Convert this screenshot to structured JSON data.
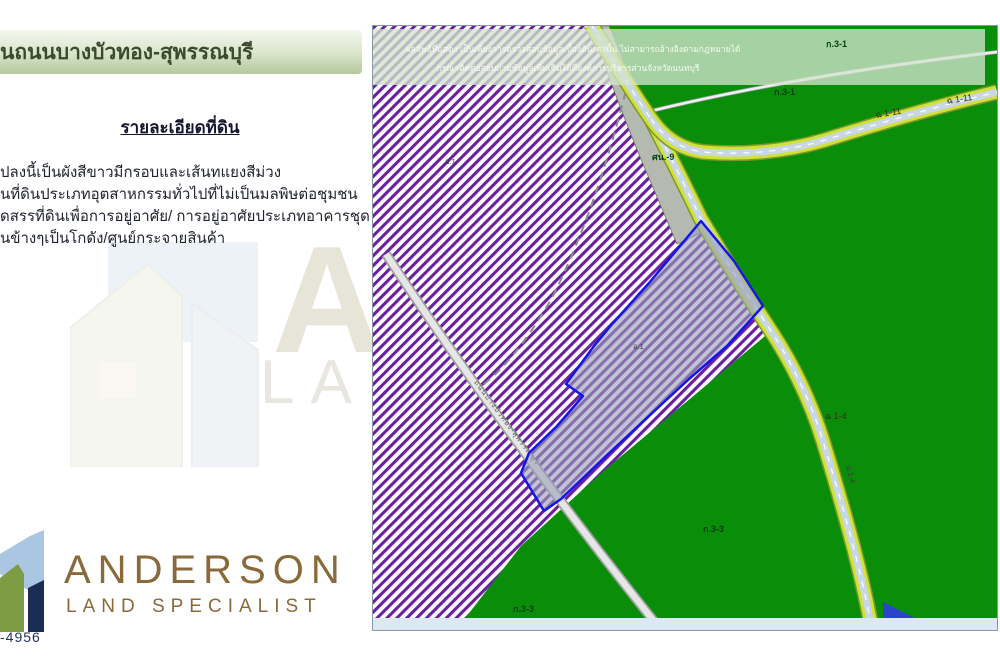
{
  "page": {
    "width": 1000,
    "height": 656
  },
  "left_panel": {
    "title": "นถนนบางบัวทอง-สุพรรณบุรี",
    "heading": "รายละเอียดที่ดิน",
    "details": [
      "ปลงนี้เป็นผังสีขาวมีกรอบและเส้นทแยงสีม่วง",
      "นที่ดินประเภทอุตสาหกรรมทั่วไปที่ไม่เป็นมลพิษต่อชุมชน",
      "ดสรรที่ดินเพื่อการอยู่อาศัย/ การอยู่อาศัยประเภทอาคารชุด",
      "นข้างๆเป็นโกดัง/ศูนย์กระจายสินค้า"
    ],
    "watermark": {
      "letter": "A",
      "word": "LAN"
    },
    "logo": {
      "name": "ANDERSON",
      "tagline": "LAND SPECIALIST"
    },
    "phone_fragment": "-4956"
  },
  "map": {
    "disclaimer": {
      "line1": "ผลลัพธ์ที่แสดง เป็นเพียงการตรวจสอบข้อมูลเบื้องต้นเท่านั้น ไม่สามารถอ้างอิงตามกฎหมายได้",
      "line2": "กรุณาติดต่อสอบถามข้อมูลเพิ่มเติมได้ที่องค์การบริหารส่วนจังหวัดนนทบุรี"
    },
    "zone_labels": {
      "k31_a": "ก.3-1",
      "k31_b": "ก.3-1",
      "sn9": "ศน.-9",
      "o1_a": "อ.1",
      "o1_b": "อ.1",
      "k33_a": "ก.3-3",
      "k33_b": "ก.3-3"
    },
    "road_labels": {
      "ch111_a": "ฉ 1-11",
      "ch111_b": "ฉ 1-11",
      "ch14": "ฉ 1-4",
      "ch14_v": "ฉ 1-4"
    },
    "road_name": "ถนนบางบัวทอง-สุพรรณบุรี",
    "colors": {
      "zone_green": "#0a8e0a",
      "hatch_purple": "#6a1fa0",
      "plot_outline": "#1515e8",
      "road_edge_yellow": "#cfe23a",
      "road_surface": "#c9d6e6",
      "gray_zone": "#b5bab0",
      "water_blue": "#2a44cc"
    }
  },
  "brand": {
    "brown": "#8a6a3a",
    "navy": "#1b2d55",
    "olive": "#7d9c44",
    "sky": "#a9c6e2"
  }
}
